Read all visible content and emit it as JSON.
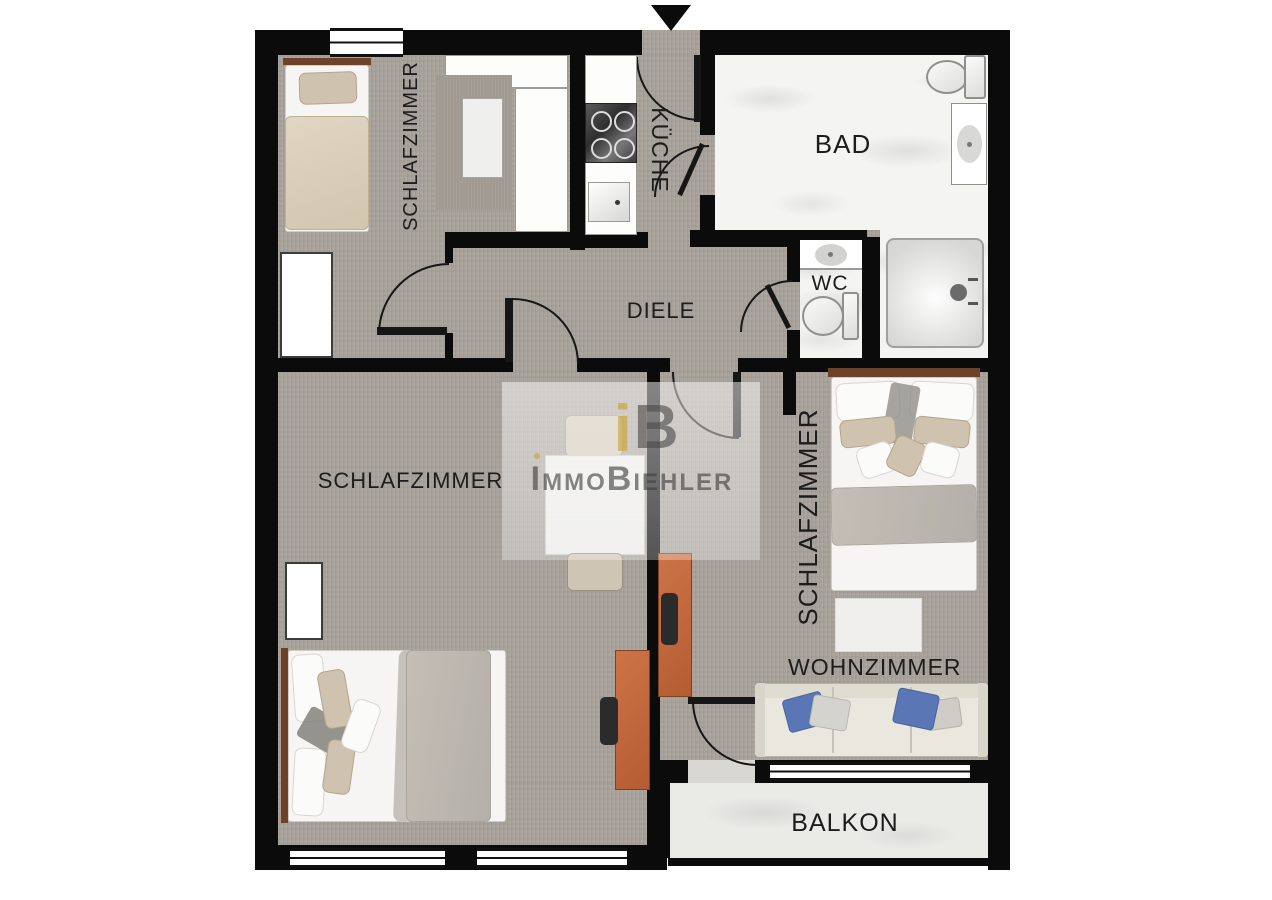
{
  "rooms": {
    "schlafzimmer_top_left": "SCHLAFZIMMER",
    "kueche": "KÜCHE",
    "bad": "BAD",
    "wc": "WC",
    "diele": "DIELE",
    "schlafzimmer_bottom_left": "SCHLAFZIMMER",
    "schlafzimmer_right": "SCHLAFZIMMER",
    "wohnzimmer": "WOHNZIMMER",
    "balkon": "BALKON"
  },
  "watermark": {
    "monogram_i": "i",
    "monogram_b": "B",
    "part1": "I",
    "part2": "MMO",
    "part3": "B",
    "part4": "IEHLER"
  },
  "colors": {
    "wall": "#0b0b0b",
    "carpet_floor": "#a9a39c",
    "marble_floor": "#f4f4f2",
    "balcony_floor": "#eaeae7",
    "brand_gold": "#c9a22c",
    "desk_orange": "#bf663c",
    "pillow_blue": "#5b76b4",
    "label_text": "#1c1c1c"
  }
}
